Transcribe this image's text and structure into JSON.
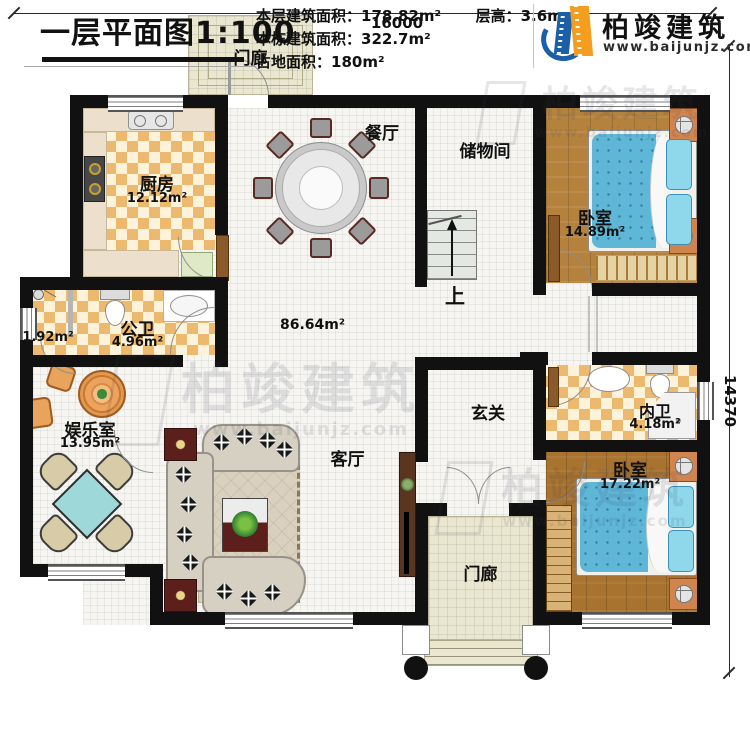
{
  "dimensions": {
    "width_mm": "16000",
    "height_mm": "14370"
  },
  "rooms": {
    "porch_top": {
      "name": "门廊"
    },
    "kitchen": {
      "name": "厨房",
      "area": "12.12m²"
    },
    "dining": {
      "name": "餐厅"
    },
    "storage": {
      "name": "储物间"
    },
    "bedroom1": {
      "name": "卧室",
      "area": "14.89m²"
    },
    "bath_public": {
      "name": "公卫",
      "area": "4.96m²"
    },
    "shower_room": {
      "area": "1.92m²"
    },
    "great_room": {
      "area": "86.64m²"
    },
    "entertainment": {
      "name": "娱乐室",
      "area": "13.95m²"
    },
    "hall": {
      "name": "玄关"
    },
    "living": {
      "name": "客厅"
    },
    "bath_ensuite": {
      "name": "内卫",
      "area": "4.18m²"
    },
    "bedroom2": {
      "name": "卧室",
      "area": "17.22m²"
    },
    "porch_bottom": {
      "name": "门廊"
    },
    "stairs": {
      "up_label": "上"
    }
  },
  "title_block": {
    "title": "一层平面图",
    "scale": "1:100",
    "stats": [
      {
        "label": "本层建筑面积：",
        "value": "178.82m²"
      },
      {
        "label": "本栋建筑面积：",
        "value": "322.7m²"
      },
      {
        "label": "占地面积：",
        "value": "180m²"
      }
    ],
    "floor_height": {
      "label": "层高：",
      "value": "3.6m"
    }
  },
  "branding": {
    "company": "柏竣建筑",
    "website": "www.baijunjz.com"
  },
  "colors": {
    "wall": "#111111",
    "logo_blue": "#1a5fa8",
    "logo_orange": "#f59d1f",
    "bed_blue": "#5fb7d8",
    "wood_light": "#b5823e",
    "wood_dark": "#a8732f",
    "checker_tile": "#edb96e",
    "table_teal": "#9ed8d8"
  }
}
